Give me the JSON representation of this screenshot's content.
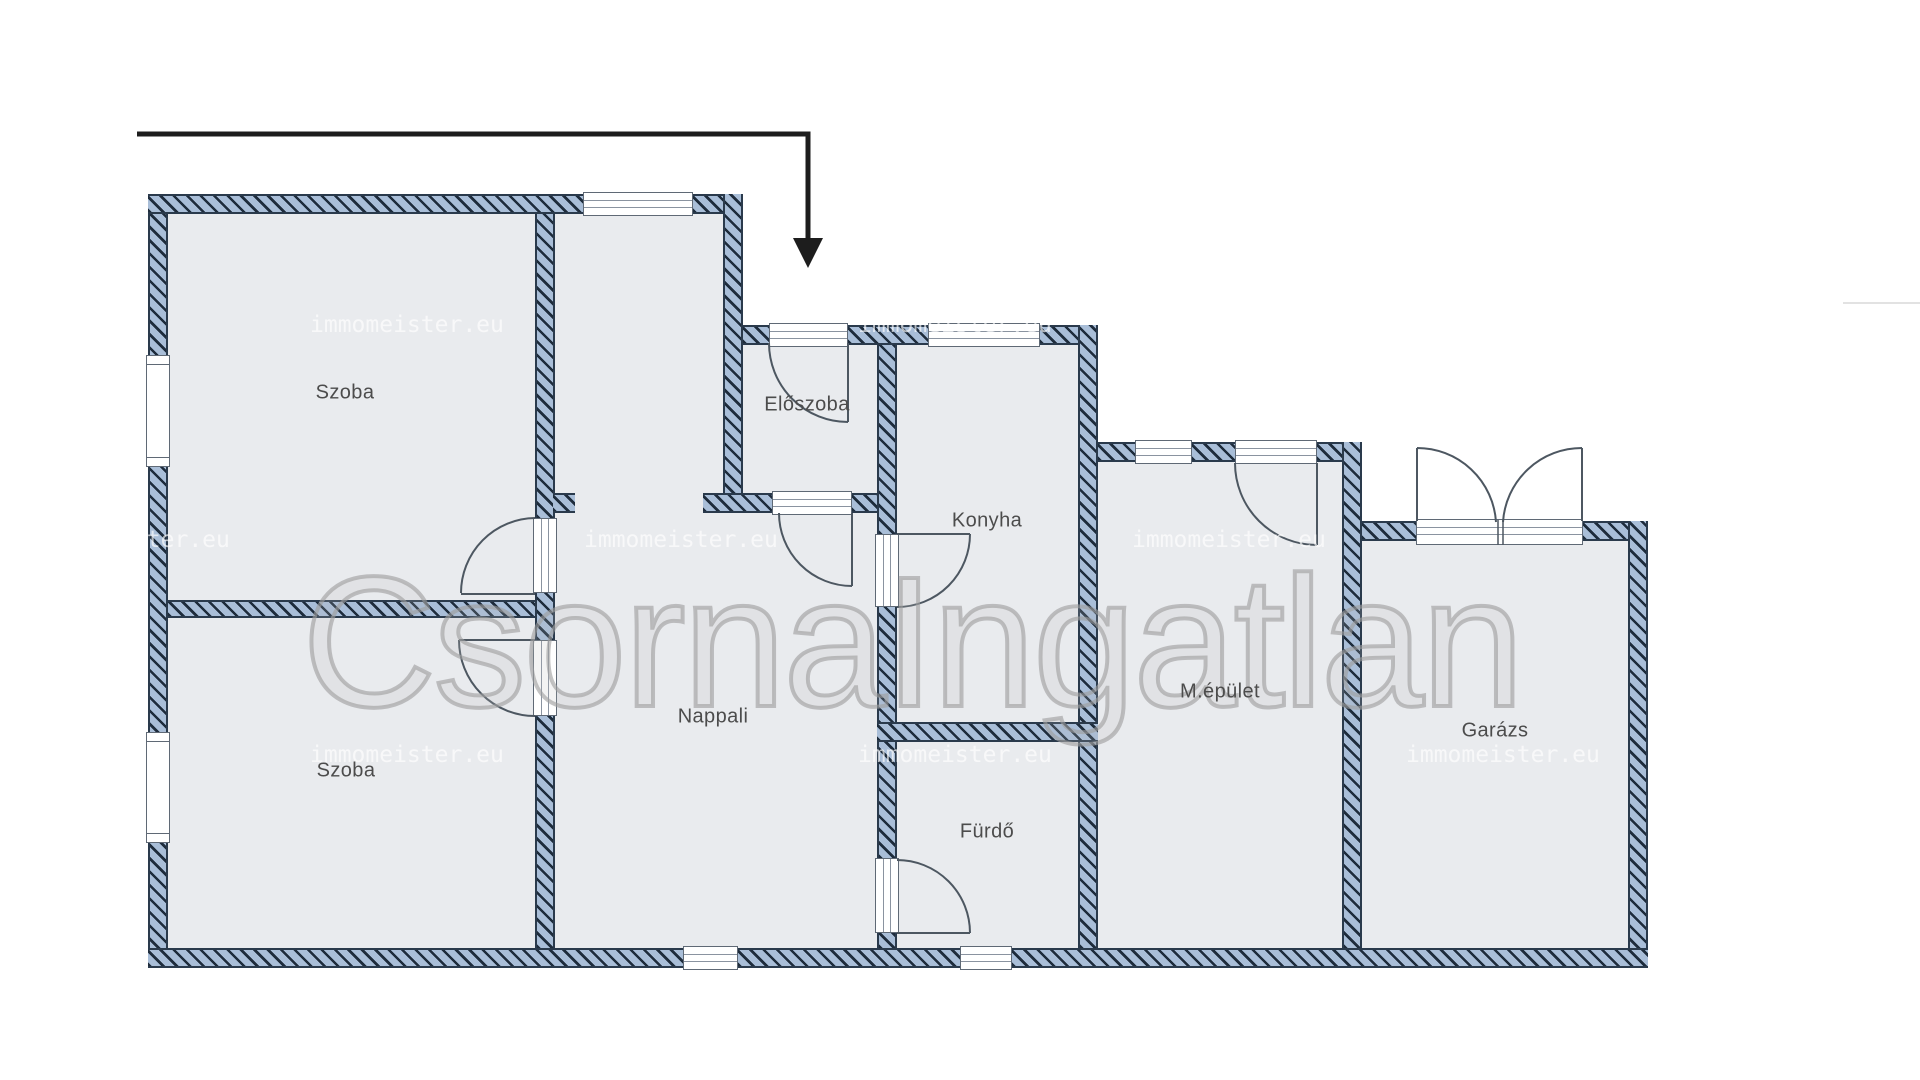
{
  "rooms": [
    {
      "id": "szoba-1",
      "label": "Szoba"
    },
    {
      "id": "szoba-2",
      "label": "Szoba"
    },
    {
      "id": "nappali",
      "label": "Nappali"
    },
    {
      "id": "eloszoba",
      "label": "Előszoba"
    },
    {
      "id": "konyha",
      "label": "Konyha"
    },
    {
      "id": "furdo",
      "label": "Fürdő"
    },
    {
      "id": "mepulet",
      "label": "M.épület"
    },
    {
      "id": "garazs",
      "label": "Garázs"
    }
  ],
  "watermarks": {
    "small_text": "immomeister.eu",
    "big_text": "CsornaIngatlan"
  },
  "colors": {
    "wall_fill": "#a9bed8",
    "wall_hatch_line": "#1e2c3c",
    "wall_edge": "#2a3a4c",
    "room_fill": "#e9ebee",
    "label_text": "#4c4c4c",
    "arrow": "#1d1d1d",
    "small_watermark": "#ffffff",
    "big_watermark": "#9e9e9e"
  }
}
